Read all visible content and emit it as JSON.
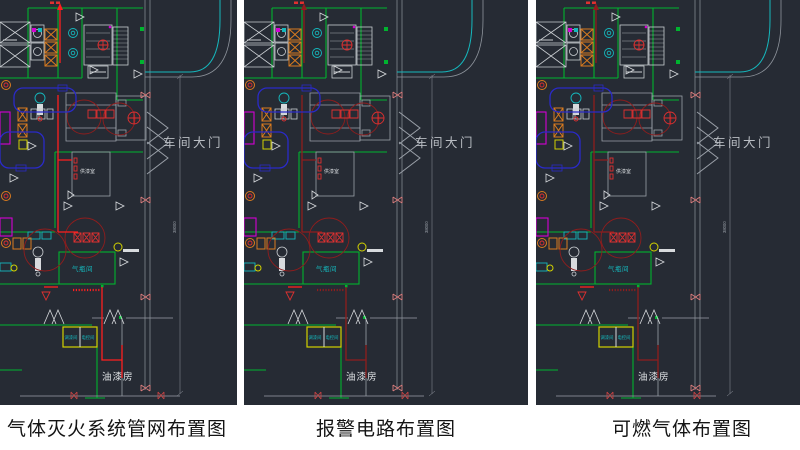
{
  "panels": [
    {
      "caption": "气体灭火系统管网布置图",
      "pipe_color": "#ff1f1f"
    },
    {
      "caption": "报警电路布置图",
      "pipe_color": "#8f1d1d"
    },
    {
      "caption": "可燃气体布置图",
      "pipe_color": "#8f1d1d"
    }
  ],
  "drawing": {
    "gate_label": "车间大门",
    "cylinder_room_label": "气瓶间",
    "paint_room_label": "油漆房",
    "supply_room_label": "供漆室",
    "dim_text": "38000",
    "electric_box_left_label": "调漆间",
    "electric_box_right_label": "电控间",
    "colors": {
      "background": "#262b34",
      "wall_green": "#00b42f",
      "line_gray": "#8e949c",
      "text_gray": "#b9bdc3",
      "cyan": "#15b8bd",
      "magenta": "#d400d4",
      "orange": "#d97b1f",
      "coverage_red": "#8f1d1d",
      "bright_red": "#ff1f1f",
      "yellow": "#d2d200",
      "conveyor_blue": "#2a2ac8"
    }
  }
}
